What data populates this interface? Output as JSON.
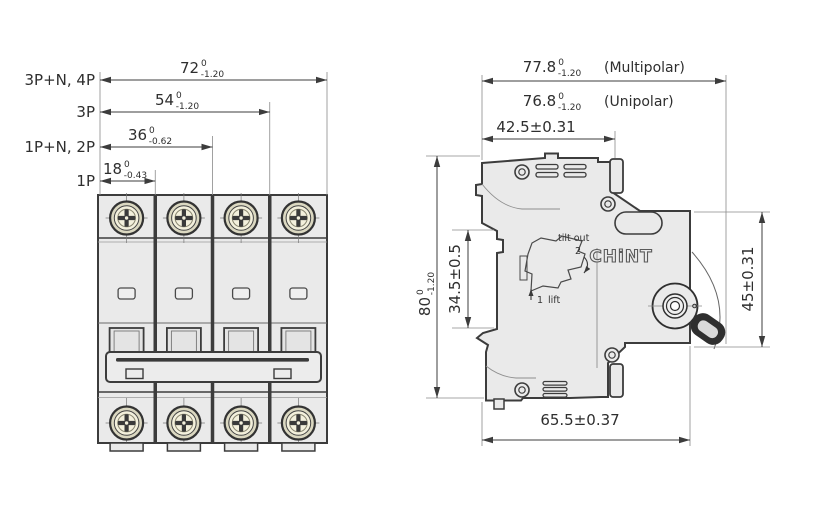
{
  "front_view": {
    "dims": [
      {
        "label": "3P+N, 4P",
        "value": "72",
        "tol_upper": "0",
        "tol_lower": "-1.20"
      },
      {
        "label": "3P",
        "value": "54",
        "tol_upper": "0",
        "tol_lower": "-1.20"
      },
      {
        "label": "1P+N, 2P",
        "value": "36",
        "tol_upper": "0",
        "tol_lower": "-0.62"
      },
      {
        "label": "1P",
        "value": "18",
        "tol_upper": "0",
        "tol_lower": "-0.43"
      }
    ]
  },
  "side_view": {
    "depth_dims": [
      {
        "value": "77.8",
        "tol_upper": "0",
        "tol_lower": "-1.20",
        "note": "(Multipolar)"
      },
      {
        "value": "76.8",
        "tol_upper": "0",
        "tol_lower": "-1.20",
        "note": "(Unipolar)"
      }
    ],
    "top_width": "42.5±0.31",
    "height": {
      "value": "80",
      "tol_upper": "0",
      "tol_lower": "-1.20"
    },
    "rail_slot_height": "34.5±0.5",
    "front_face_height": "45±0.31",
    "body_depth": "65.5±0.37",
    "clip_steps": {
      "step2": "2",
      "tilt_out_label": "tilt out",
      "step1": "1",
      "lift_label": "lift"
    },
    "logo": "CHiNT"
  },
  "colors": {
    "body_fill": "#eaeaea",
    "outline": "#3c3c3c",
    "screw_fill": "#f3f0dc",
    "dim_color": "#3c3c3c"
  }
}
